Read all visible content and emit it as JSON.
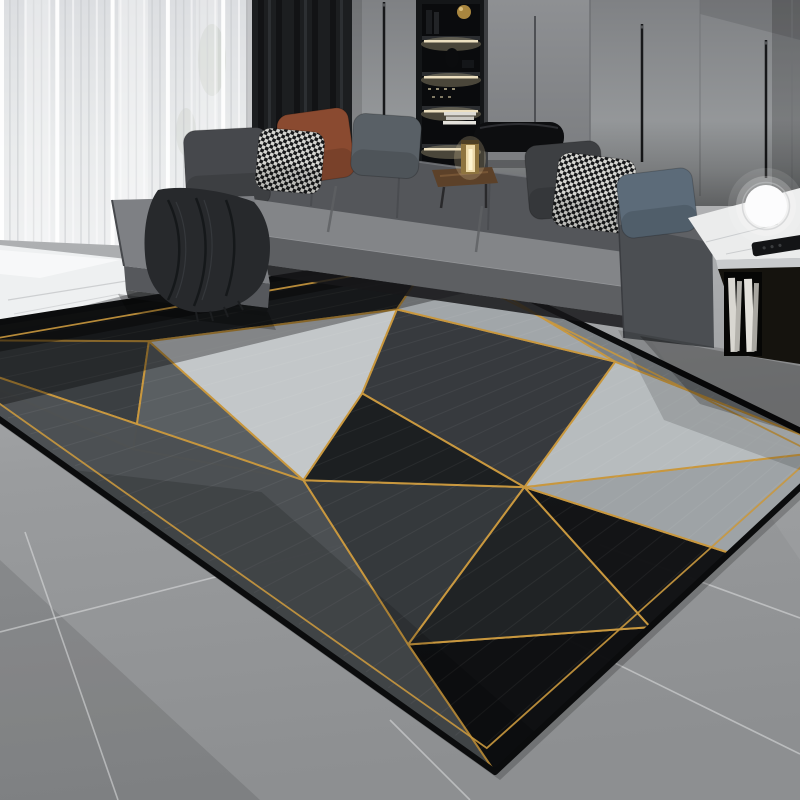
{
  "scene": {
    "type": "photograph",
    "description": "Modern gray living room: L-shaped fabric sectional sofa with assorted pillows and a dark throw, sheer and blackout curtains, backlit shelving beside gray cabinet panels, integrated bronze corner table with brass cylinder lamp, white marble side table with glowing sphere lamp and remote, large geometric area rug of black/gray triangles outlined in gold over big gray concrete tiles with a white marble strip near the window.",
    "objects": [
      "sheer-curtain",
      "blackout-curtain",
      "wall-panels",
      "backlit-shelf",
      "cabinet",
      "sectional-sofa",
      "chaise",
      "throw-blanket",
      "pillows",
      "bolster-cushion",
      "corner-table",
      "brass-lamp",
      "marble-side-table",
      "sphere-lamp",
      "remote-control",
      "books",
      "geometric-rug",
      "tile-floor",
      "marble-floor-strip"
    ]
  },
  "palette": {
    "wall": "#8f9194",
    "sheer_curtain": "#e9ebec",
    "dark_curtain": "#1c1e20",
    "sofa": "#7e8083",
    "sofa_shadow": "#55575b",
    "pillow_rust": "#8a4a30",
    "pillow_blue": "#5c6b79",
    "throw_blanket": "#27292c",
    "rug_gold": "#c9983e",
    "rug_black": "#0e0f11",
    "rug_light": "#c5c9cb",
    "floor_tile": "#9b9d9f",
    "grout": "#e0e1e2",
    "marble": "#eef0f1",
    "lamp_glow": "#f0dcaa",
    "brass": "#8e743f"
  },
  "curtains": {
    "sheer_streaks": 34,
    "streak_step": 7.9,
    "streak_bottom": 250
  },
  "wall": {
    "seams": [
      [
        554,
        0,
        170
      ],
      [
        590,
        0,
        168
      ],
      [
        700,
        0,
        196
      ],
      [
        792,
        0,
        188
      ]
    ],
    "rods": [
      [
        384,
        2,
        160
      ],
      [
        642,
        24,
        162
      ],
      [
        766,
        40,
        178
      ]
    ]
  },
  "shelf": {
    "boards": [
      36,
      72,
      106,
      144
    ],
    "led_rows": [
      40,
      76,
      110,
      148
    ]
  },
  "pillows": [
    {
      "name": "pillow-charcoal-left",
      "cx": 227,
      "cy": 168,
      "w": 84,
      "h": 78,
      "rot": -3,
      "fill": "#46484c"
    },
    {
      "name": "pillow-rust",
      "cx": 316,
      "cy": 146,
      "w": 72,
      "h": 70,
      "rot": -8,
      "fill": "#8a4a30"
    },
    {
      "name": "pillow-houndstooth-left",
      "cx": 290,
      "cy": 161,
      "w": 66,
      "h": 62,
      "rot": 5,
      "fill": "url(#hound)"
    },
    {
      "name": "pillow-gray-green",
      "cx": 386,
      "cy": 146,
      "w": 68,
      "h": 62,
      "rot": 4,
      "fill": "#596066"
    },
    {
      "name": "pillow-charcoal-right",
      "cx": 565,
      "cy": 180,
      "w": 76,
      "h": 74,
      "rot": -5,
      "fill": "#3d3f42"
    },
    {
      "name": "pillow-houndstooth-right",
      "cx": 594,
      "cy": 193,
      "w": 78,
      "h": 74,
      "rot": 7,
      "fill": "url(#hound)"
    },
    {
      "name": "pillow-blue",
      "cx": 657,
      "cy": 203,
      "w": 76,
      "h": 64,
      "rot": -7,
      "fill": "#5c6b79"
    }
  ],
  "rug": {
    "corners": {
      "top": [
        435,
        253
      ],
      "right": [
        840,
        450
      ],
      "bottom": [
        495,
        772
      ],
      "left": [
        -112,
        340
      ]
    },
    "points": {
      "d0": [
        0,
        0
      ],
      "a0": [
        1,
        0
      ],
      "b0": [
        1,
        1
      ],
      "c0": [
        0,
        1
      ],
      "f1": [
        0.38,
        0.1
      ],
      "f2": [
        0.8,
        0.16
      ],
      "ll": [
        0.13,
        0.3
      ],
      "g1": [
        0.56,
        0.34
      ],
      "g2": [
        0.3,
        0.46
      ],
      "g3": [
        0.57,
        0.66
      ],
      "g4": [
        0.95,
        0.5
      ],
      "e1": [
        0.12,
        0.78
      ],
      "n1": [
        0.45,
        1
      ],
      "e2": [
        0.68,
        1
      ]
    },
    "triangles": [
      {
        "pts": [
          "d0",
          "a0",
          "f2",
          "f1"
        ],
        "fill": "#212426"
      },
      {
        "pts": [
          "d0",
          "f1",
          "ll"
        ],
        "fill": "#3a3e41"
      },
      {
        "pts": [
          "d0",
          "ll",
          "g2"
        ],
        "fill": "#9aa0a3"
      },
      {
        "pts": [
          "f1",
          "ll",
          "g2"
        ],
        "fill": "#5a5f62"
      },
      {
        "pts": [
          "d0",
          "g2",
          "c0"
        ],
        "fill": "#4c5053"
      },
      {
        "pts": [
          "c0",
          "g2",
          "e1"
        ],
        "fill": "#17191b"
      },
      {
        "pts": [
          "c0",
          "e1",
          "n1"
        ],
        "fill": "#0e0f11"
      },
      {
        "pts": [
          "g2",
          "g3",
          "e1"
        ],
        "fill": "#34383b"
      },
      {
        "pts": [
          "e1",
          "g3",
          "n1"
        ],
        "fill": "#1f2224"
      },
      {
        "pts": [
          "n1",
          "g3",
          "e2"
        ],
        "fill": "#121315"
      },
      {
        "pts": [
          "e2",
          "g3",
          "b0"
        ],
        "fill": "#9fa4a7"
      },
      {
        "pts": [
          "g3",
          "g4",
          "b0"
        ],
        "fill": "#b9bec0"
      },
      {
        "pts": [
          "f1",
          "f2",
          "g1",
          "g2"
        ],
        "fill": "#c5c9cb"
      },
      {
        "pts": [
          "f2",
          "g4",
          "g3",
          "g1"
        ],
        "fill": "#36393d"
      },
      {
        "pts": [
          "g1",
          "g3",
          "g2"
        ],
        "fill": "#1b1e20"
      },
      {
        "pts": [
          "f2",
          "a0",
          "g4"
        ],
        "fill": "#a2a7aa"
      },
      {
        "pts": [
          "a0",
          "b0",
          "g4"
        ],
        "fill": "#7c8184"
      }
    ],
    "overlays": [
      {
        "pts": [
          [
            0,
            0
          ],
          [
            1,
            0
          ],
          [
            1,
            0.16
          ],
          [
            0,
            0.16
          ]
        ],
        "fill": "#000000",
        "opacity": 0.33
      },
      {
        "pts": [
          [
            0,
            0
          ],
          [
            1,
            0
          ],
          [
            1,
            0.06
          ],
          [
            0,
            0.06
          ]
        ],
        "fill": "#000000",
        "opacity": 0.35
      },
      {
        "pts": [
          [
            0,
            0.3
          ],
          [
            0.22,
            0.45
          ],
          [
            0.12,
            1
          ],
          [
            0,
            1
          ]
        ],
        "fill": "#000000",
        "opacity": 0.15
      }
    ],
    "gold": "#c9983e",
    "gold_width": 2,
    "border_inset": 0.032,
    "edge_color": "#0b0c0d",
    "edge_width": 6,
    "texture_lines": 26
  },
  "floor": {
    "grout_lines": [
      [
        0,
        632,
        345,
        544
      ],
      [
        25,
        532,
        118,
        800
      ],
      [
        390,
        720,
        470,
        800
      ],
      [
        600,
        545,
        800,
        618
      ],
      [
        560,
        636,
        800,
        754
      ],
      [
        700,
        418,
        800,
        452
      ]
    ]
  },
  "side_table": {
    "books": [
      [
        728,
        278,
        7,
        74
      ],
      [
        737,
        281,
        5,
        70
      ],
      [
        744,
        279,
        8,
        73
      ],
      [
        754,
        283,
        5,
        68
      ]
    ]
  }
}
